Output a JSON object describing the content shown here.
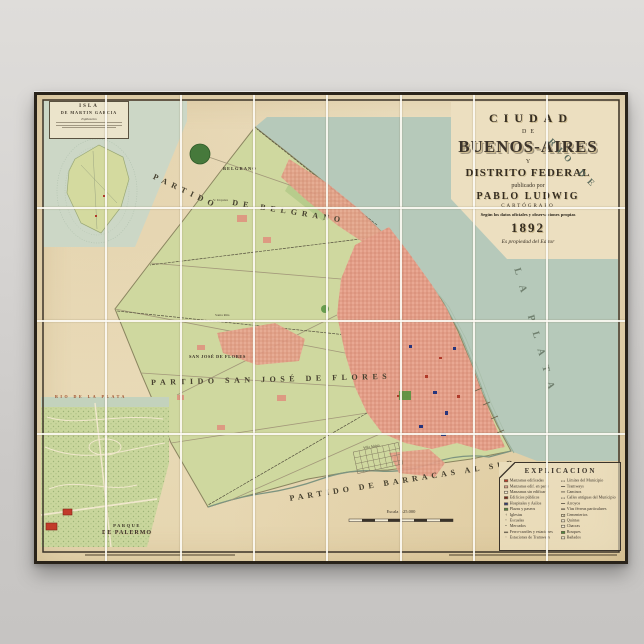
{
  "colors": {
    "wall": "#d6d4d2",
    "paper": "#e9dcba",
    "frame": "#29231a",
    "land_green": "#cfd89f",
    "water_green": "#b6c9ba",
    "city_pink": "#e9a893",
    "accent_red": "#b03a2a",
    "accent_blue": "#27357c",
    "park_green": "#c9d69c",
    "ink": "#3a332a"
  },
  "poster": {
    "title_block": {
      "ciudad": "CIUDAD",
      "de": "DE",
      "buenos_aires": "BUENOS-AIRES",
      "y": "Y",
      "distrito": "DISTRITO FEDERAL",
      "publicado": "publicado por",
      "pablo": "PABLO LUDWIG",
      "cartografo": "CARTÓGRAFO",
      "segun": "Según los datos oficiales y observaciones propias",
      "anio": "1892",
      "propiedad": "Es propiedad del Editor"
    },
    "map_labels": {
      "rio_de": "RIO DE",
      "la_plata": "LA PLATA",
      "partido_p1": "PARTIDO",
      "partido_p2": "DE BELGRANO",
      "belgrano_town": "BELGRANO",
      "villa_urquiza": "V. Urquiza",
      "santa_rita": "Santa Rita",
      "flores_town": "SAN JOSÉ DE FLORES",
      "partido_flores": "PARTIDO SAN JOSÉ DE FLORES",
      "partido_barracas": "PARTIDO DE BARRACAS AL SUD",
      "villa_alsina": "Villa Alsina",
      "scale": "Escala 1:25.000"
    },
    "inset_isla": {
      "title": "ISLA",
      "subtitle": "DE MARTIN GARCIA",
      "note": "Explicacion"
    },
    "inset_palermo": {
      "river": "RIO DE LA PLATA",
      "title1": "PARQUE",
      "title2": "DE PALERMO"
    },
    "legend": {
      "title": "EXPLICACION",
      "left": [
        {
          "label": "Manzanas edificadas"
        },
        {
          "label": "Manzanas edif. en parte"
        },
        {
          "label": "Manzanas sin edificar"
        },
        {
          "label": "Edificios públicos"
        },
        {
          "label": "Hospitales y Asilos"
        },
        {
          "label": "Plazas y paseos"
        },
        {
          "label": "Iglesias"
        },
        {
          "label": "Escuelas"
        },
        {
          "label": "Mercados"
        },
        {
          "label": "Ferro-carriles y estaciones"
        },
        {
          "label": "Estaciones de Tramways"
        }
      ],
      "right": [
        {
          "label": "Límites del Municipio"
        },
        {
          "label": "Tramways"
        },
        {
          "label": "Caminos"
        },
        {
          "label": "Calles antiguas del Municipio"
        },
        {
          "label": "Arroyos"
        },
        {
          "label": "Vías férreas particulares"
        },
        {
          "label": "Cementerios"
        },
        {
          "label": "Quintas"
        },
        {
          "label": "Chacras"
        },
        {
          "label": "Bosques"
        },
        {
          "label": "Bañados"
        }
      ]
    }
  }
}
